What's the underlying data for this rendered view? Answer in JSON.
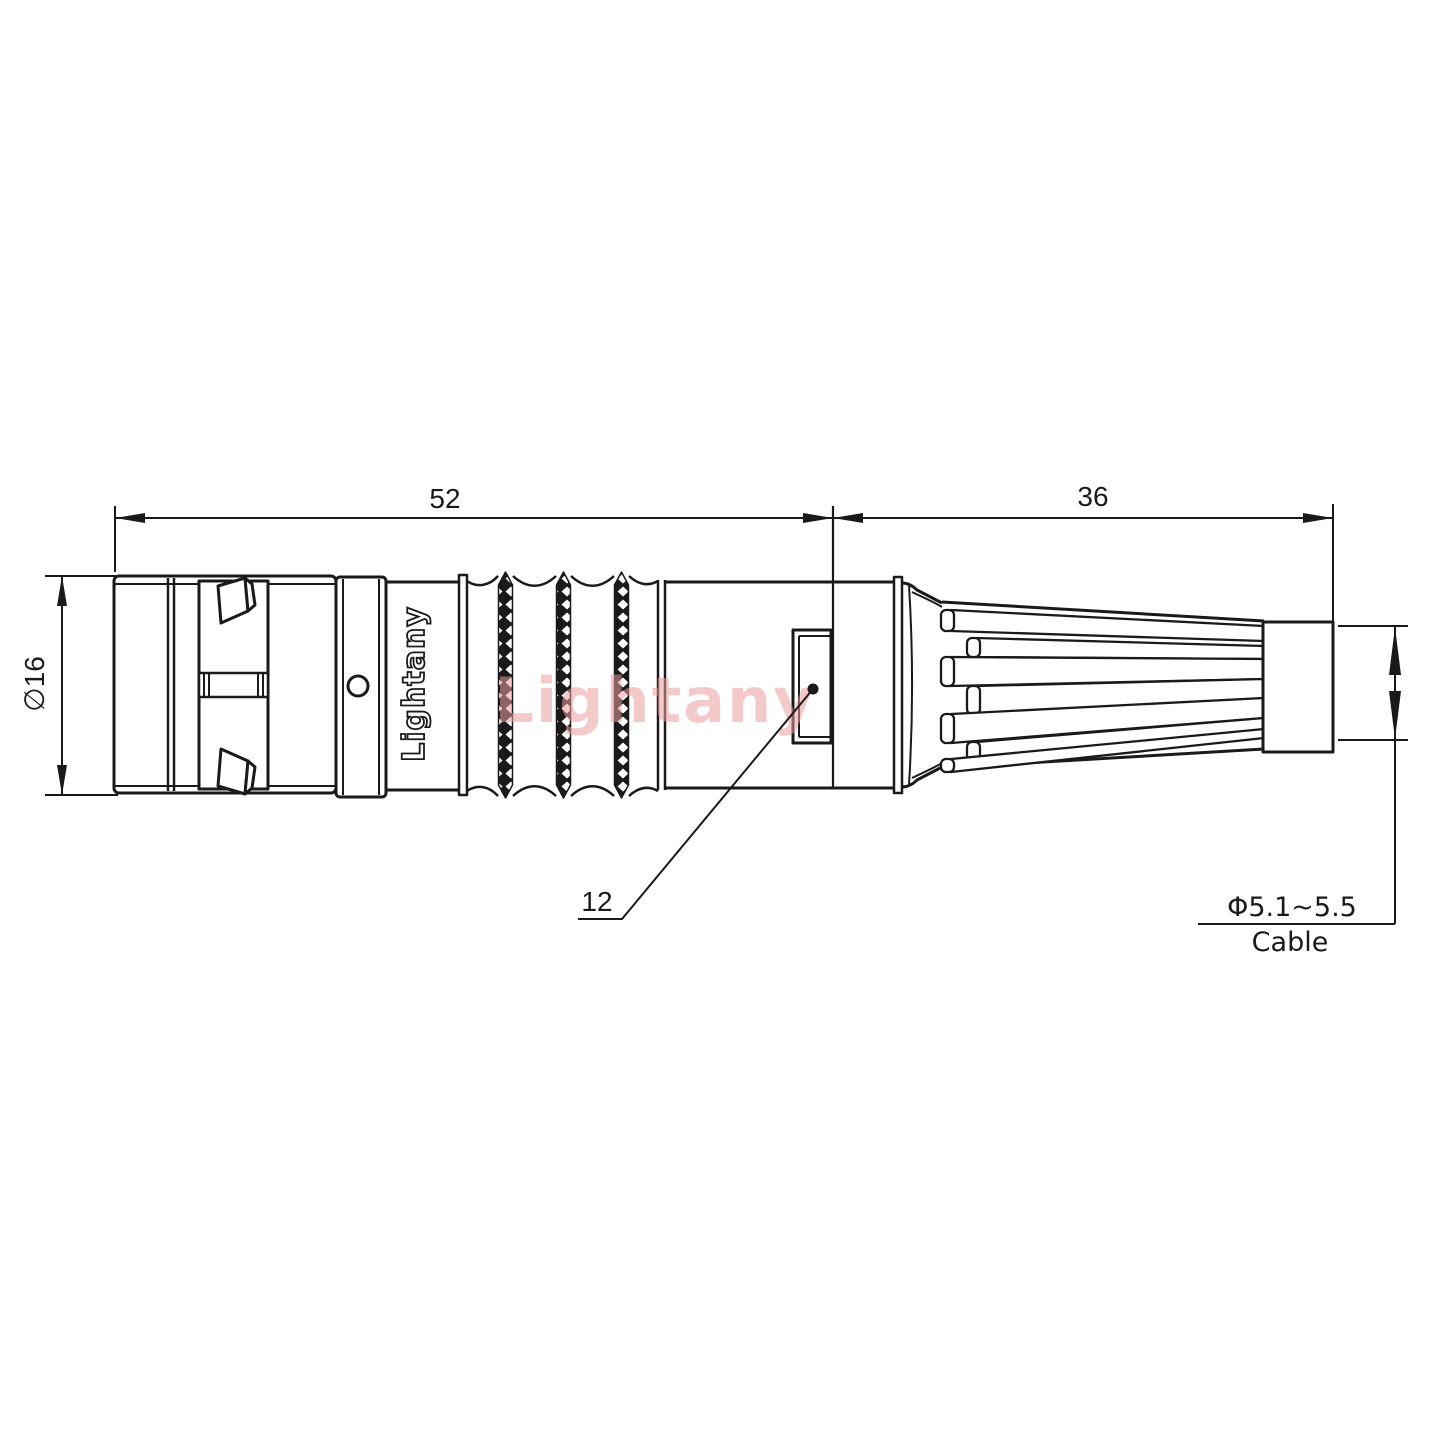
{
  "dimensions": {
    "overall_length": "52",
    "rear_length": "36",
    "front_diameter": "∅16",
    "nut_width": "12",
    "cable_diameter": "Φ5.1~5.5",
    "cable_label": "Cable"
  },
  "branding": {
    "body_marking": "Lightany",
    "watermark": "Lightany"
  },
  "colors": {
    "line": "#1a1a1a",
    "watermark": "#ec9e9e",
    "background": "#ffffff"
  }
}
